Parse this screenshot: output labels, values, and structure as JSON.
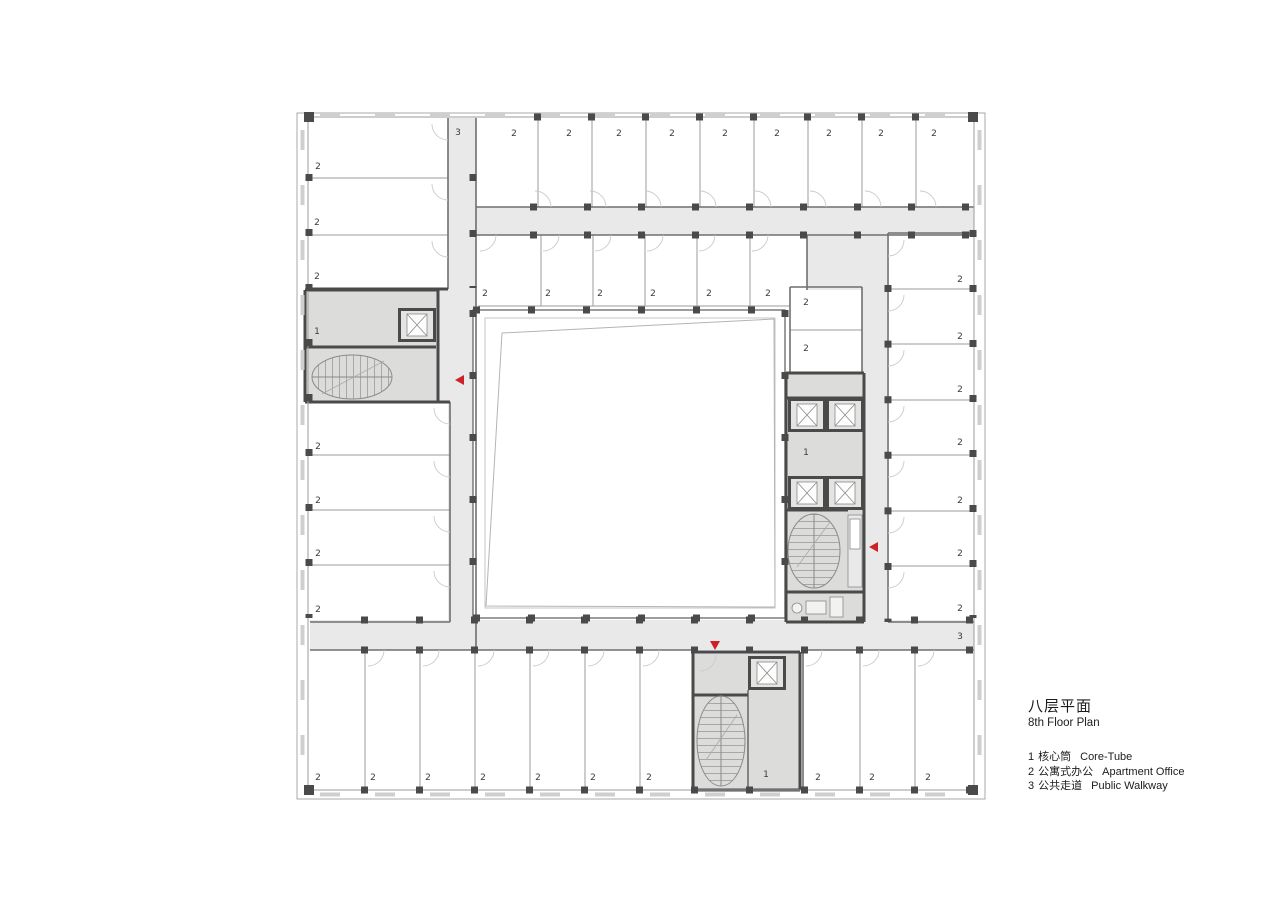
{
  "legend": {
    "title_zh": "八层平面",
    "title_en": "8th Floor Plan",
    "items": [
      {
        "num": "1",
        "zh": "核心筒",
        "en": "Core-Tube"
      },
      {
        "num": "2",
        "zh": "公寓式办公",
        "en": "Apartment Office"
      },
      {
        "num": "3",
        "zh": "公共走道",
        "en": "Public Walkway"
      }
    ]
  },
  "plan": {
    "colors": {
      "corridor": "#e9e9e9",
      "core": "#dcdcda",
      "wall_dark": "#4a4a4a",
      "marker_red": "#ce2127",
      "atrium": "#ffffff"
    },
    "room_labels": [
      {
        "t": "3",
        "x": 458,
        "y": 132
      },
      {
        "t": "3",
        "x": 960,
        "y": 636
      },
      {
        "t": "1",
        "x": 317,
        "y": 331
      },
      {
        "t": "1",
        "x": 806,
        "y": 452
      },
      {
        "t": "1",
        "x": 766,
        "y": 774
      },
      {
        "t": "2",
        "x": 318,
        "y": 166
      },
      {
        "t": "2",
        "x": 317,
        "y": 222
      },
      {
        "t": "2",
        "x": 317,
        "y": 276
      },
      {
        "t": "2",
        "x": 514,
        "y": 133
      },
      {
        "t": "2",
        "x": 569,
        "y": 133
      },
      {
        "t": "2",
        "x": 619,
        "y": 133
      },
      {
        "t": "2",
        "x": 672,
        "y": 133
      },
      {
        "t": "2",
        "x": 725,
        "y": 133
      },
      {
        "t": "2",
        "x": 777,
        "y": 133
      },
      {
        "t": "2",
        "x": 829,
        "y": 133
      },
      {
        "t": "2",
        "x": 881,
        "y": 133
      },
      {
        "t": "2",
        "x": 934,
        "y": 133
      },
      {
        "t": "2",
        "x": 485,
        "y": 293
      },
      {
        "t": "2",
        "x": 548,
        "y": 293
      },
      {
        "t": "2",
        "x": 600,
        "y": 293
      },
      {
        "t": "2",
        "x": 653,
        "y": 293
      },
      {
        "t": "2",
        "x": 709,
        "y": 293
      },
      {
        "t": "2",
        "x": 768,
        "y": 293
      },
      {
        "t": "2",
        "x": 806,
        "y": 302
      },
      {
        "t": "2",
        "x": 806,
        "y": 348
      },
      {
        "t": "2",
        "x": 960,
        "y": 279
      },
      {
        "t": "2",
        "x": 960,
        "y": 336
      },
      {
        "t": "2",
        "x": 960,
        "y": 389
      },
      {
        "t": "2",
        "x": 960,
        "y": 442
      },
      {
        "t": "2",
        "x": 960,
        "y": 500
      },
      {
        "t": "2",
        "x": 960,
        "y": 553
      },
      {
        "t": "2",
        "x": 960,
        "y": 608
      },
      {
        "t": "2",
        "x": 318,
        "y": 446
      },
      {
        "t": "2",
        "x": 318,
        "y": 500
      },
      {
        "t": "2",
        "x": 318,
        "y": 553
      },
      {
        "t": "2",
        "x": 318,
        "y": 609
      },
      {
        "t": "2",
        "x": 318,
        "y": 777
      },
      {
        "t": "2",
        "x": 373,
        "y": 777
      },
      {
        "t": "2",
        "x": 428,
        "y": 777
      },
      {
        "t": "2",
        "x": 483,
        "y": 777
      },
      {
        "t": "2",
        "x": 538,
        "y": 777
      },
      {
        "t": "2",
        "x": 593,
        "y": 777
      },
      {
        "t": "2",
        "x": 649,
        "y": 777
      },
      {
        "t": "2",
        "x": 818,
        "y": 777
      },
      {
        "t": "2",
        "x": 872,
        "y": 777
      },
      {
        "t": "2",
        "x": 928,
        "y": 777
      }
    ],
    "markers": [
      {
        "type": "section-arrow-left",
        "x": 455,
        "y": 380
      },
      {
        "type": "section-arrow-left",
        "x": 869,
        "y": 547
      },
      {
        "type": "section-arrow-down",
        "x": 715,
        "y": 647
      }
    ]
  }
}
